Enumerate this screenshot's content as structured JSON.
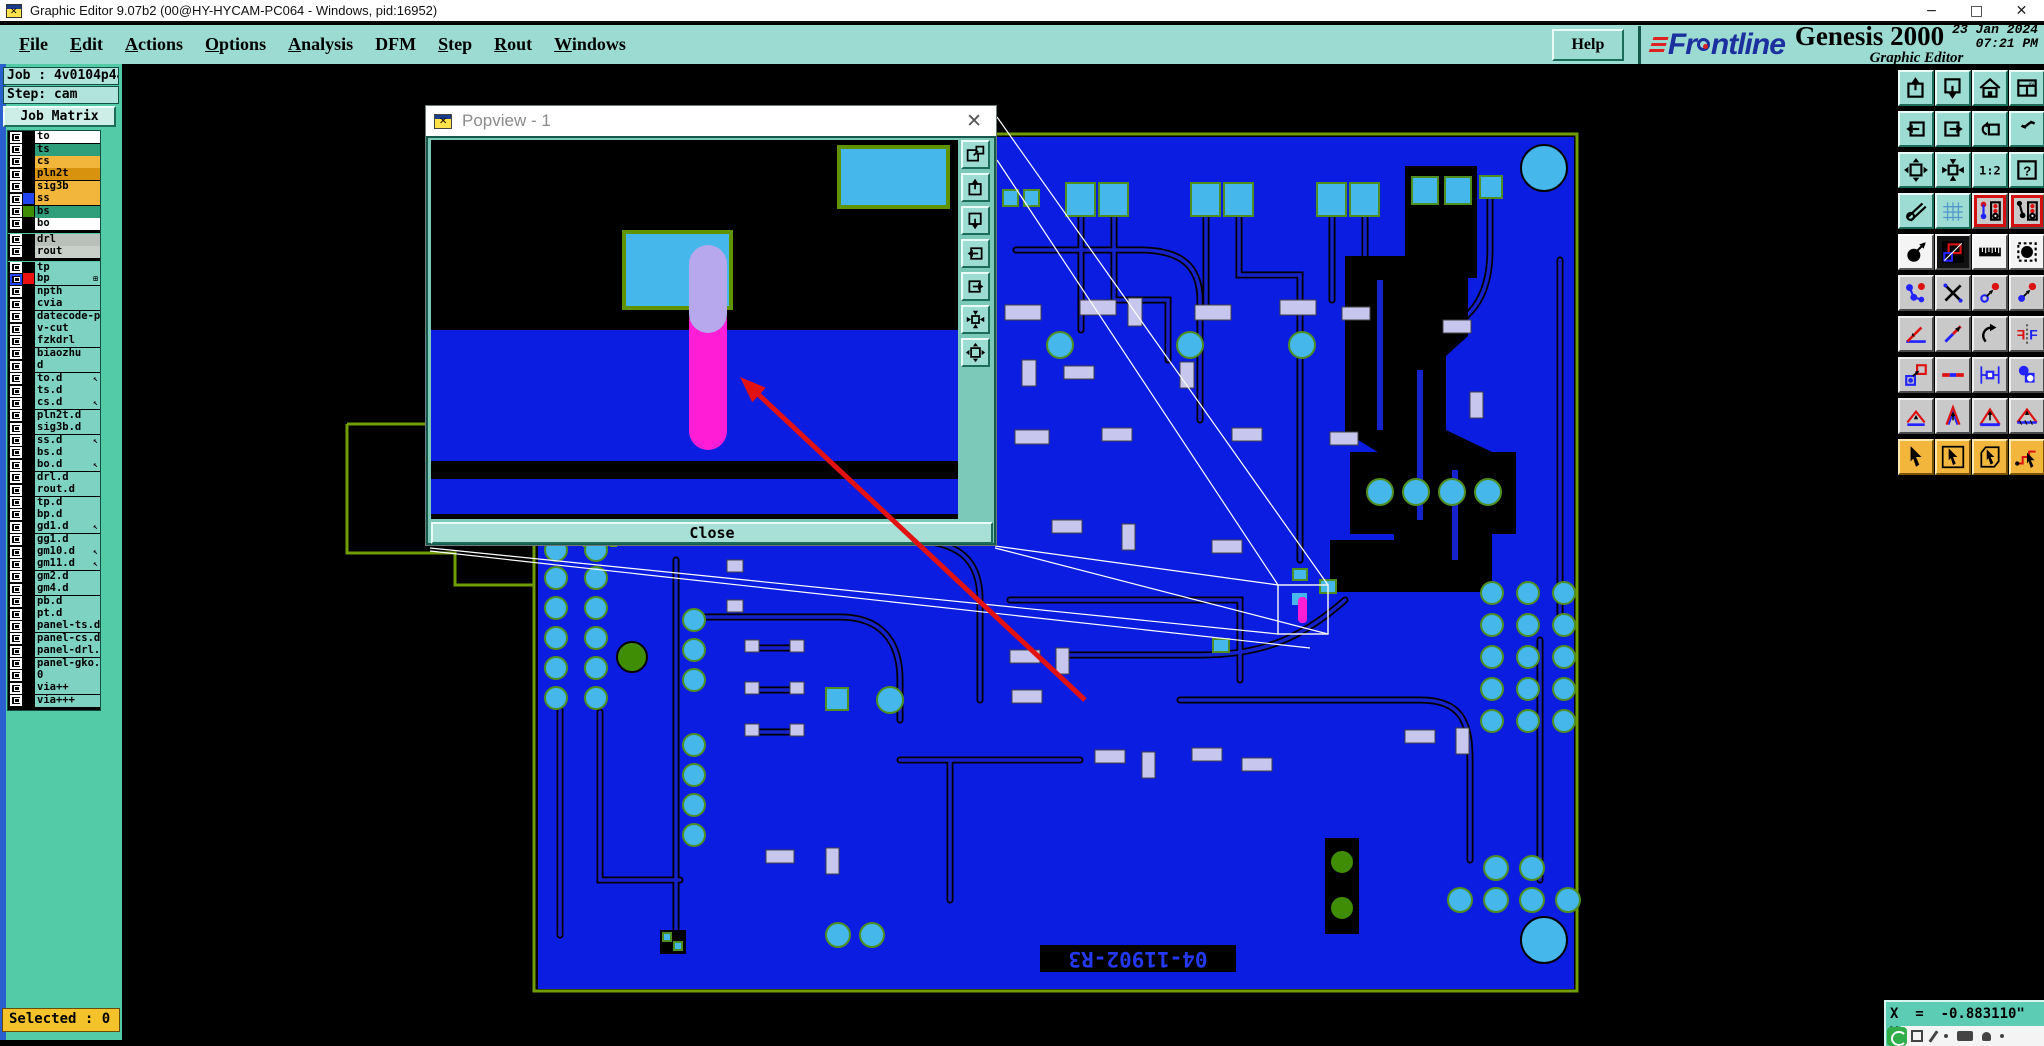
{
  "window": {
    "title": "Graphic Editor 9.07b2 (00@HY-HYCAM-PC064 - Windows, pid:16952)",
    "minimize": "−",
    "maximize": "□",
    "close": "✕"
  },
  "menu": {
    "items": [
      {
        "label": "File",
        "u": 0
      },
      {
        "label": "Edit",
        "u": 0
      },
      {
        "label": "Actions",
        "u": 0
      },
      {
        "label": "Options",
        "u": 0
      },
      {
        "label": "Analysis",
        "u": 0
      },
      {
        "label": "DFM",
        "u": -1
      },
      {
        "label": "Step",
        "u": 0
      },
      {
        "label": "Rout",
        "u": 0
      },
      {
        "label": "Windows",
        "u": 0
      }
    ],
    "help_label": "Help"
  },
  "brand": {
    "logo_fr": "Fr",
    "logo_ntline": "ntline",
    "product": "Genesis 2000",
    "date": "23 Jan 2024",
    "time": "07:21 PM",
    "subtitle": "Graphic Editor"
  },
  "sidebar": {
    "job_label": "Job : 4v0104p4a0",
    "step_label": "Step: cam",
    "job_matrix_label": "Job Matrix ...",
    "selected_label": "Selected : 0",
    "layer_default_bg": "#7ed2c2",
    "layers": [
      {
        "label": "to",
        "bg": "#ffffff"
      },
      {
        "label": "ts",
        "bg": "#2f9e7a"
      },
      {
        "label": "cs",
        "bg": "#f2b63c"
      },
      {
        "label": "pln2t",
        "bg": "#d8920e"
      },
      {
        "label": "sig3b",
        "bg": "#f2b63c"
      },
      {
        "label": "ss",
        "bg": "#f2b63c",
        "swatch": "#2244ee"
      },
      {
        "label": "bs",
        "bg": "#2f9e7a",
        "swatch": "#3f8c05"
      },
      {
        "label": "bo",
        "bg": "#ffffff"
      },
      {
        "label": "drl",
        "bg": "#b9c0ba",
        "gap": true
      },
      {
        "label": "rout",
        "bg": "#c9cfc9"
      },
      {
        "label": "tp",
        "gap": true
      },
      {
        "label": "bp",
        "swatch": "#ee1111",
        "sel": true,
        "glyph": "⊞"
      },
      {
        "label": "npth"
      },
      {
        "label": "cvia"
      },
      {
        "label": "datecode-pb"
      },
      {
        "label": "v-cut"
      },
      {
        "label": "fzkdrl"
      },
      {
        "label": "biaozhu"
      },
      {
        "label": "d"
      },
      {
        "label": "to.d",
        "glyph": "↖"
      },
      {
        "label": "ts.d"
      },
      {
        "label": "cs.d",
        "glyph": "↖"
      },
      {
        "label": "pln2t.d"
      },
      {
        "label": "sig3b.d"
      },
      {
        "label": "ss.d",
        "glyph": "↖"
      },
      {
        "label": "bs.d"
      },
      {
        "label": "bo.d",
        "glyph": "↖"
      },
      {
        "label": "drl.d"
      },
      {
        "label": "rout.d"
      },
      {
        "label": "tp.d"
      },
      {
        "label": "bp.d"
      },
      {
        "label": "gd1.d",
        "glyph": "↖"
      },
      {
        "label": "gg1.d"
      },
      {
        "label": "gm10.d",
        "glyph": "↖"
      },
      {
        "label": "gm11.d",
        "glyph": "↖"
      },
      {
        "label": "gm2.d"
      },
      {
        "label": "gm4.d"
      },
      {
        "label": "pb.d"
      },
      {
        "label": "pt.d"
      },
      {
        "label": "panel-ts.d"
      },
      {
        "label": "panel-cs.d"
      },
      {
        "label": "panel-drl.d"
      },
      {
        "label": "panel-gko.d"
      },
      {
        "label": "0"
      },
      {
        "label": "via++"
      },
      {
        "label": "via+++"
      }
    ]
  },
  "popview": {
    "title": "Popview - 1",
    "close_x": "✕",
    "close_label": "Close",
    "tools": [
      {
        "name": "popview-window-button",
        "icon": "win-pop"
      },
      {
        "name": "pan-up-button",
        "icon": "box-up"
      },
      {
        "name": "pan-down-button",
        "icon": "box-down"
      },
      {
        "name": "pan-left-button",
        "icon": "box-arrow-left"
      },
      {
        "name": "pan-right-button",
        "icon": "box-arrow-right"
      },
      {
        "name": "zoom-center-button",
        "icon": "box-center"
      },
      {
        "name": "zoom-expand-button",
        "icon": "box-expand"
      }
    ]
  },
  "canvas": {
    "board_text": "04-11902-R3",
    "colors": {
      "board_blue": "#0a1de0",
      "trace_blue": "#1523cc",
      "pad_cyan": "#45b7ea",
      "pad_lavender": "#c7c6ee",
      "outline_olive": "#6f9c07",
      "drill_green": "#3f8c05",
      "highlight_magenta": "#ff1ed6",
      "arrow_red": "#e31212"
    }
  },
  "status": {
    "x_readout": "X  =  -0.883110\"",
    "y_readout": "Y  =  2.625009\""
  },
  "toolbar_right": {
    "buttons": [
      {
        "name": "paste-up-button",
        "icon": "box-up",
        "bg": "teal"
      },
      {
        "name": "screen-down-button",
        "icon": "box-down",
        "bg": "teal"
      },
      {
        "name": "home-view-button",
        "icon": "home",
        "bg": "teal"
      },
      {
        "name": "window-xy-button",
        "icon": "win-xy",
        "bg": "teal"
      },
      {
        "name": "zoom-in-button",
        "icon": "box-arrow-left",
        "bg": "teal"
      },
      {
        "name": "zoom-out-button",
        "icon": "box-arrow-right",
        "bg": "teal"
      },
      {
        "name": "previous-view-button",
        "icon": "undo-box",
        "bg": "teal"
      },
      {
        "name": "profile-button",
        "icon": "s-curve",
        "bg": "teal"
      },
      {
        "name": "fit-margins-button",
        "icon": "box-expand",
        "bg": "teal"
      },
      {
        "name": "center-view-button",
        "icon": "box-center",
        "bg": "teal"
      },
      {
        "name": "scale-1-2-button",
        "icon": "one-two",
        "bg": "teal"
      },
      {
        "name": "context-help-button",
        "icon": "query-box",
        "bg": "teal"
      },
      {
        "name": "setup-tools-button",
        "icon": "tools",
        "bg": "teal"
      },
      {
        "name": "grid-button",
        "icon": "grid",
        "bg": "teal"
      },
      {
        "name": "netlist-cur-button",
        "icon": "netlist",
        "bg": "gray",
        "sel": true
      },
      {
        "name": "netlist-ref-button",
        "icon": "netlist2",
        "bg": "gray",
        "sel": true
      },
      {
        "name": "move-pad-button",
        "icon": "pad-arrow",
        "bg": "white"
      },
      {
        "name": "negative-view-button",
        "icon": "neg-rect",
        "bg": "dark"
      },
      {
        "name": "ruler-button",
        "icon": "ruler",
        "bg": "white"
      },
      {
        "name": "select-pad-button",
        "icon": "pad-dash",
        "bg": "white"
      },
      {
        "name": "net-chain-button",
        "icon": "chain",
        "bg": "gray"
      },
      {
        "name": "clear-highlight-button",
        "icon": "del-x",
        "bg": "gray"
      },
      {
        "name": "copy-to-open-button",
        "icon": "copy-open",
        "bg": "gray"
      },
      {
        "name": "copy-to-filled-button",
        "icon": "copy-filled",
        "bg": "gray"
      },
      {
        "name": "angle-button",
        "icon": "angle",
        "bg": "gray"
      },
      {
        "name": "slant-line-button",
        "icon": "slant",
        "bg": "gray"
      },
      {
        "name": "rotate-button",
        "icon": "rotate",
        "bg": "gray"
      },
      {
        "name": "mirror-button",
        "icon": "mirror-f",
        "bg": "gray"
      },
      {
        "name": "swap-pad-button",
        "icon": "pad-swap",
        "bg": "gray"
      },
      {
        "name": "segment-button",
        "icon": "dash-line",
        "bg": "gray"
      },
      {
        "name": "measure-button",
        "icon": "measure",
        "bg": "gray"
      },
      {
        "name": "touching-pads-button",
        "icon": "pads-touch",
        "bg": "gray"
      },
      {
        "name": "arc-mode-1-button",
        "icon": "tri-1",
        "bg": "gray"
      },
      {
        "name": "arc-mode-2-button",
        "icon": "tri-2",
        "bg": "gray"
      },
      {
        "name": "arc-mode-3-button",
        "icon": "tri-3",
        "bg": "gray"
      },
      {
        "name": "arc-mode-4-button",
        "icon": "tri-4",
        "bg": "gray"
      },
      {
        "name": "select-single-button",
        "icon": "cursor",
        "bg": "orange"
      },
      {
        "name": "select-frame-button",
        "icon": "cursor-box",
        "bg": "orange"
      },
      {
        "name": "select-poly-button",
        "icon": "cursor-poly",
        "bg": "orange"
      },
      {
        "name": "select-net-button",
        "icon": "cursor-net",
        "bg": "orange"
      }
    ]
  }
}
